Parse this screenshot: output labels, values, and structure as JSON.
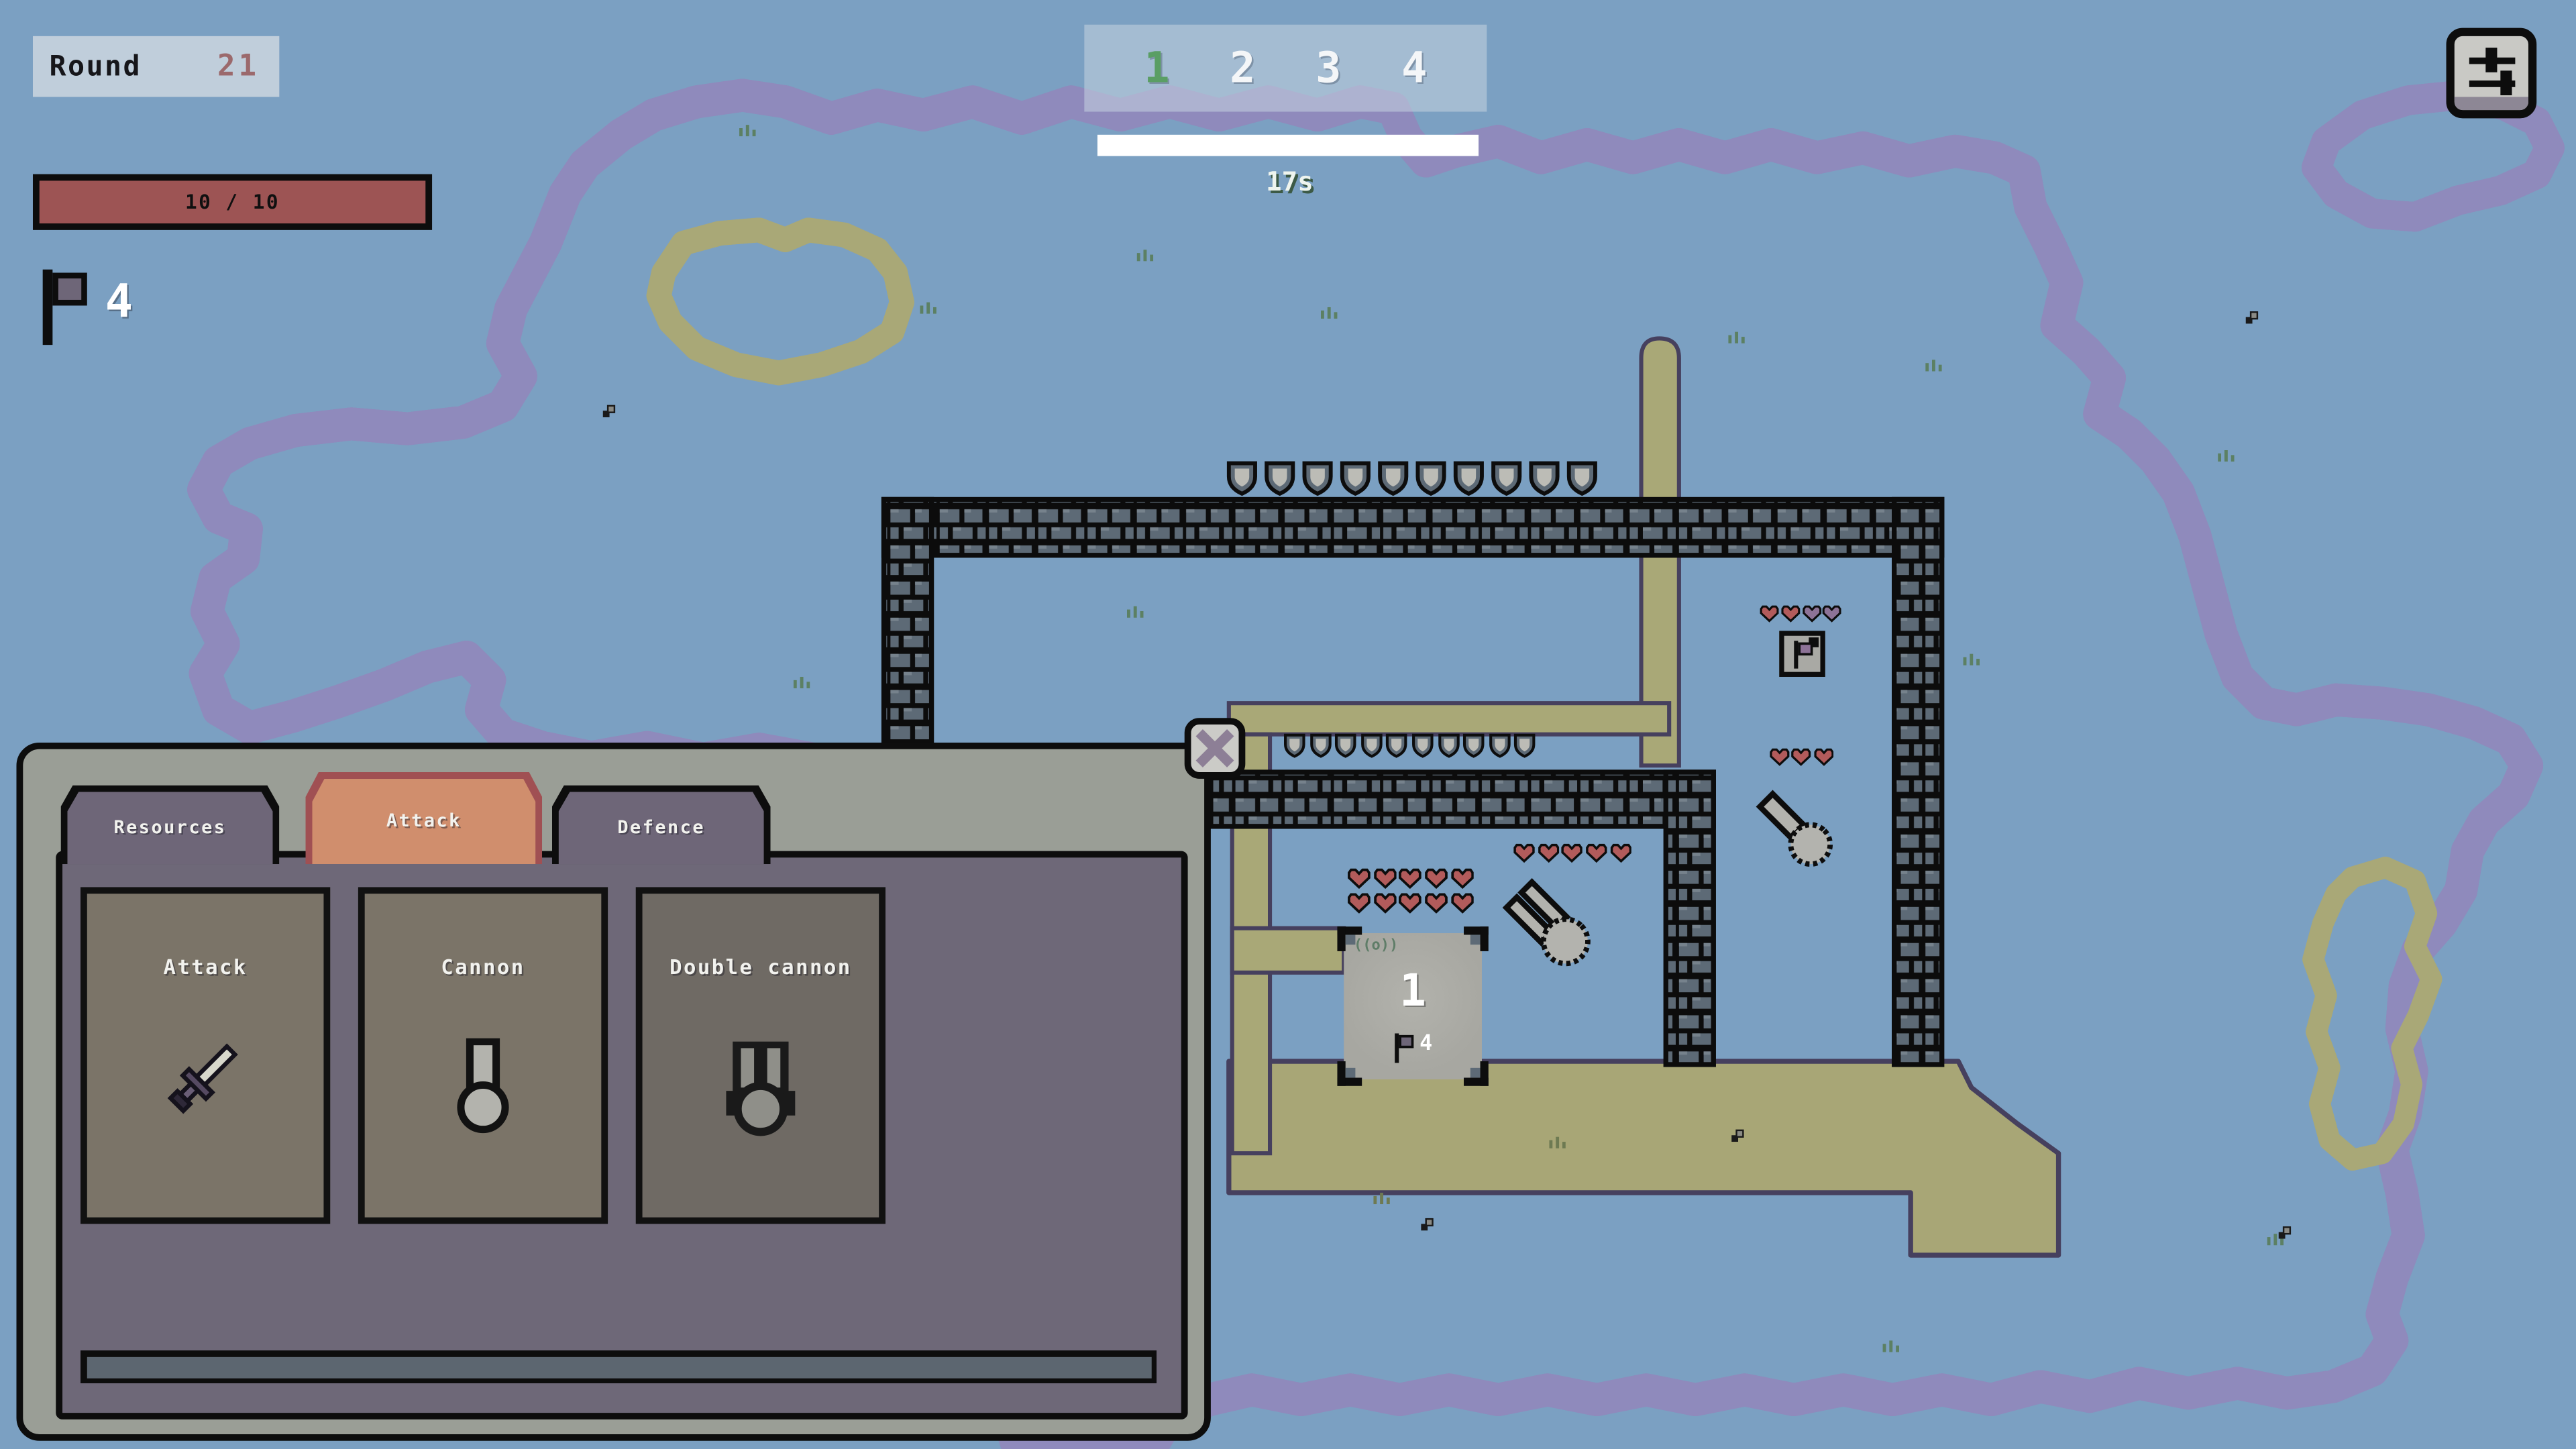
{
  "hud": {
    "round_label": "Round",
    "round_value": "21",
    "health_display": "10 / 10",
    "health_current": 10,
    "health_max": 10,
    "flag_count": "4",
    "wave": {
      "items": [
        "1",
        "2",
        "3",
        "4"
      ],
      "active_index": 0,
      "timer": "17s"
    },
    "settings_icon": "sliders-icon"
  },
  "panel": {
    "tabs": [
      {
        "label": "Resources",
        "active": false
      },
      {
        "label": "Attack",
        "active": true
      },
      {
        "label": "Defence",
        "active": false
      }
    ],
    "cards": [
      {
        "title": "Attack",
        "icon": "sword-icon"
      },
      {
        "title": "Cannon",
        "icon": "cannon-icon"
      },
      {
        "title": "Double cannon",
        "icon": "double-cannon-icon"
      }
    ]
  },
  "map": {
    "base": {
      "number": "1",
      "flag_count": "4",
      "corner_symbol": "((o))",
      "hearts": {
        "count": 10,
        "colors": [
          "#b25b5b"
        ]
      }
    },
    "double_cannon_defender": {
      "hearts": {
        "count": 5,
        "colors": [
          "#b25b5b"
        ]
      }
    },
    "cannon_defender": {
      "hearts": {
        "count": 3,
        "colors": [
          "#b25b5b"
        ]
      }
    },
    "outpost": {
      "hearts": {
        "count": 4,
        "colors": [
          "#b25b5b",
          "#b25b5b",
          "#8d7397",
          "#8d7397"
        ]
      }
    },
    "walls": {
      "shields_top": {
        "count": 10
      },
      "shields_inner": {
        "count": 10
      }
    }
  },
  "colors": {
    "water": "#7ba0c2",
    "grass": "#75aa7b",
    "sand": "#a9a877",
    "coast_outline": "#46405e",
    "coast_glow": "#8f8abc",
    "lake": "#8ca89e",
    "lake_rim": "#6a7884",
    "khaki": "#a8a676",
    "brick": "#5d6a76",
    "heart_red": "#b25b5b",
    "heart_purple": "#8d7397",
    "wave_active": "#5a9e64",
    "health_fill": "#9d5454",
    "tab_active": "#d08e6d",
    "tab_active_border": "#a05053",
    "tab_inactive": "#6e6678",
    "panel_frame": "#9a9e96",
    "panel_body": "#6e6878",
    "card_bg": "#7b7468",
    "strip_fill": "#5c6670"
  }
}
